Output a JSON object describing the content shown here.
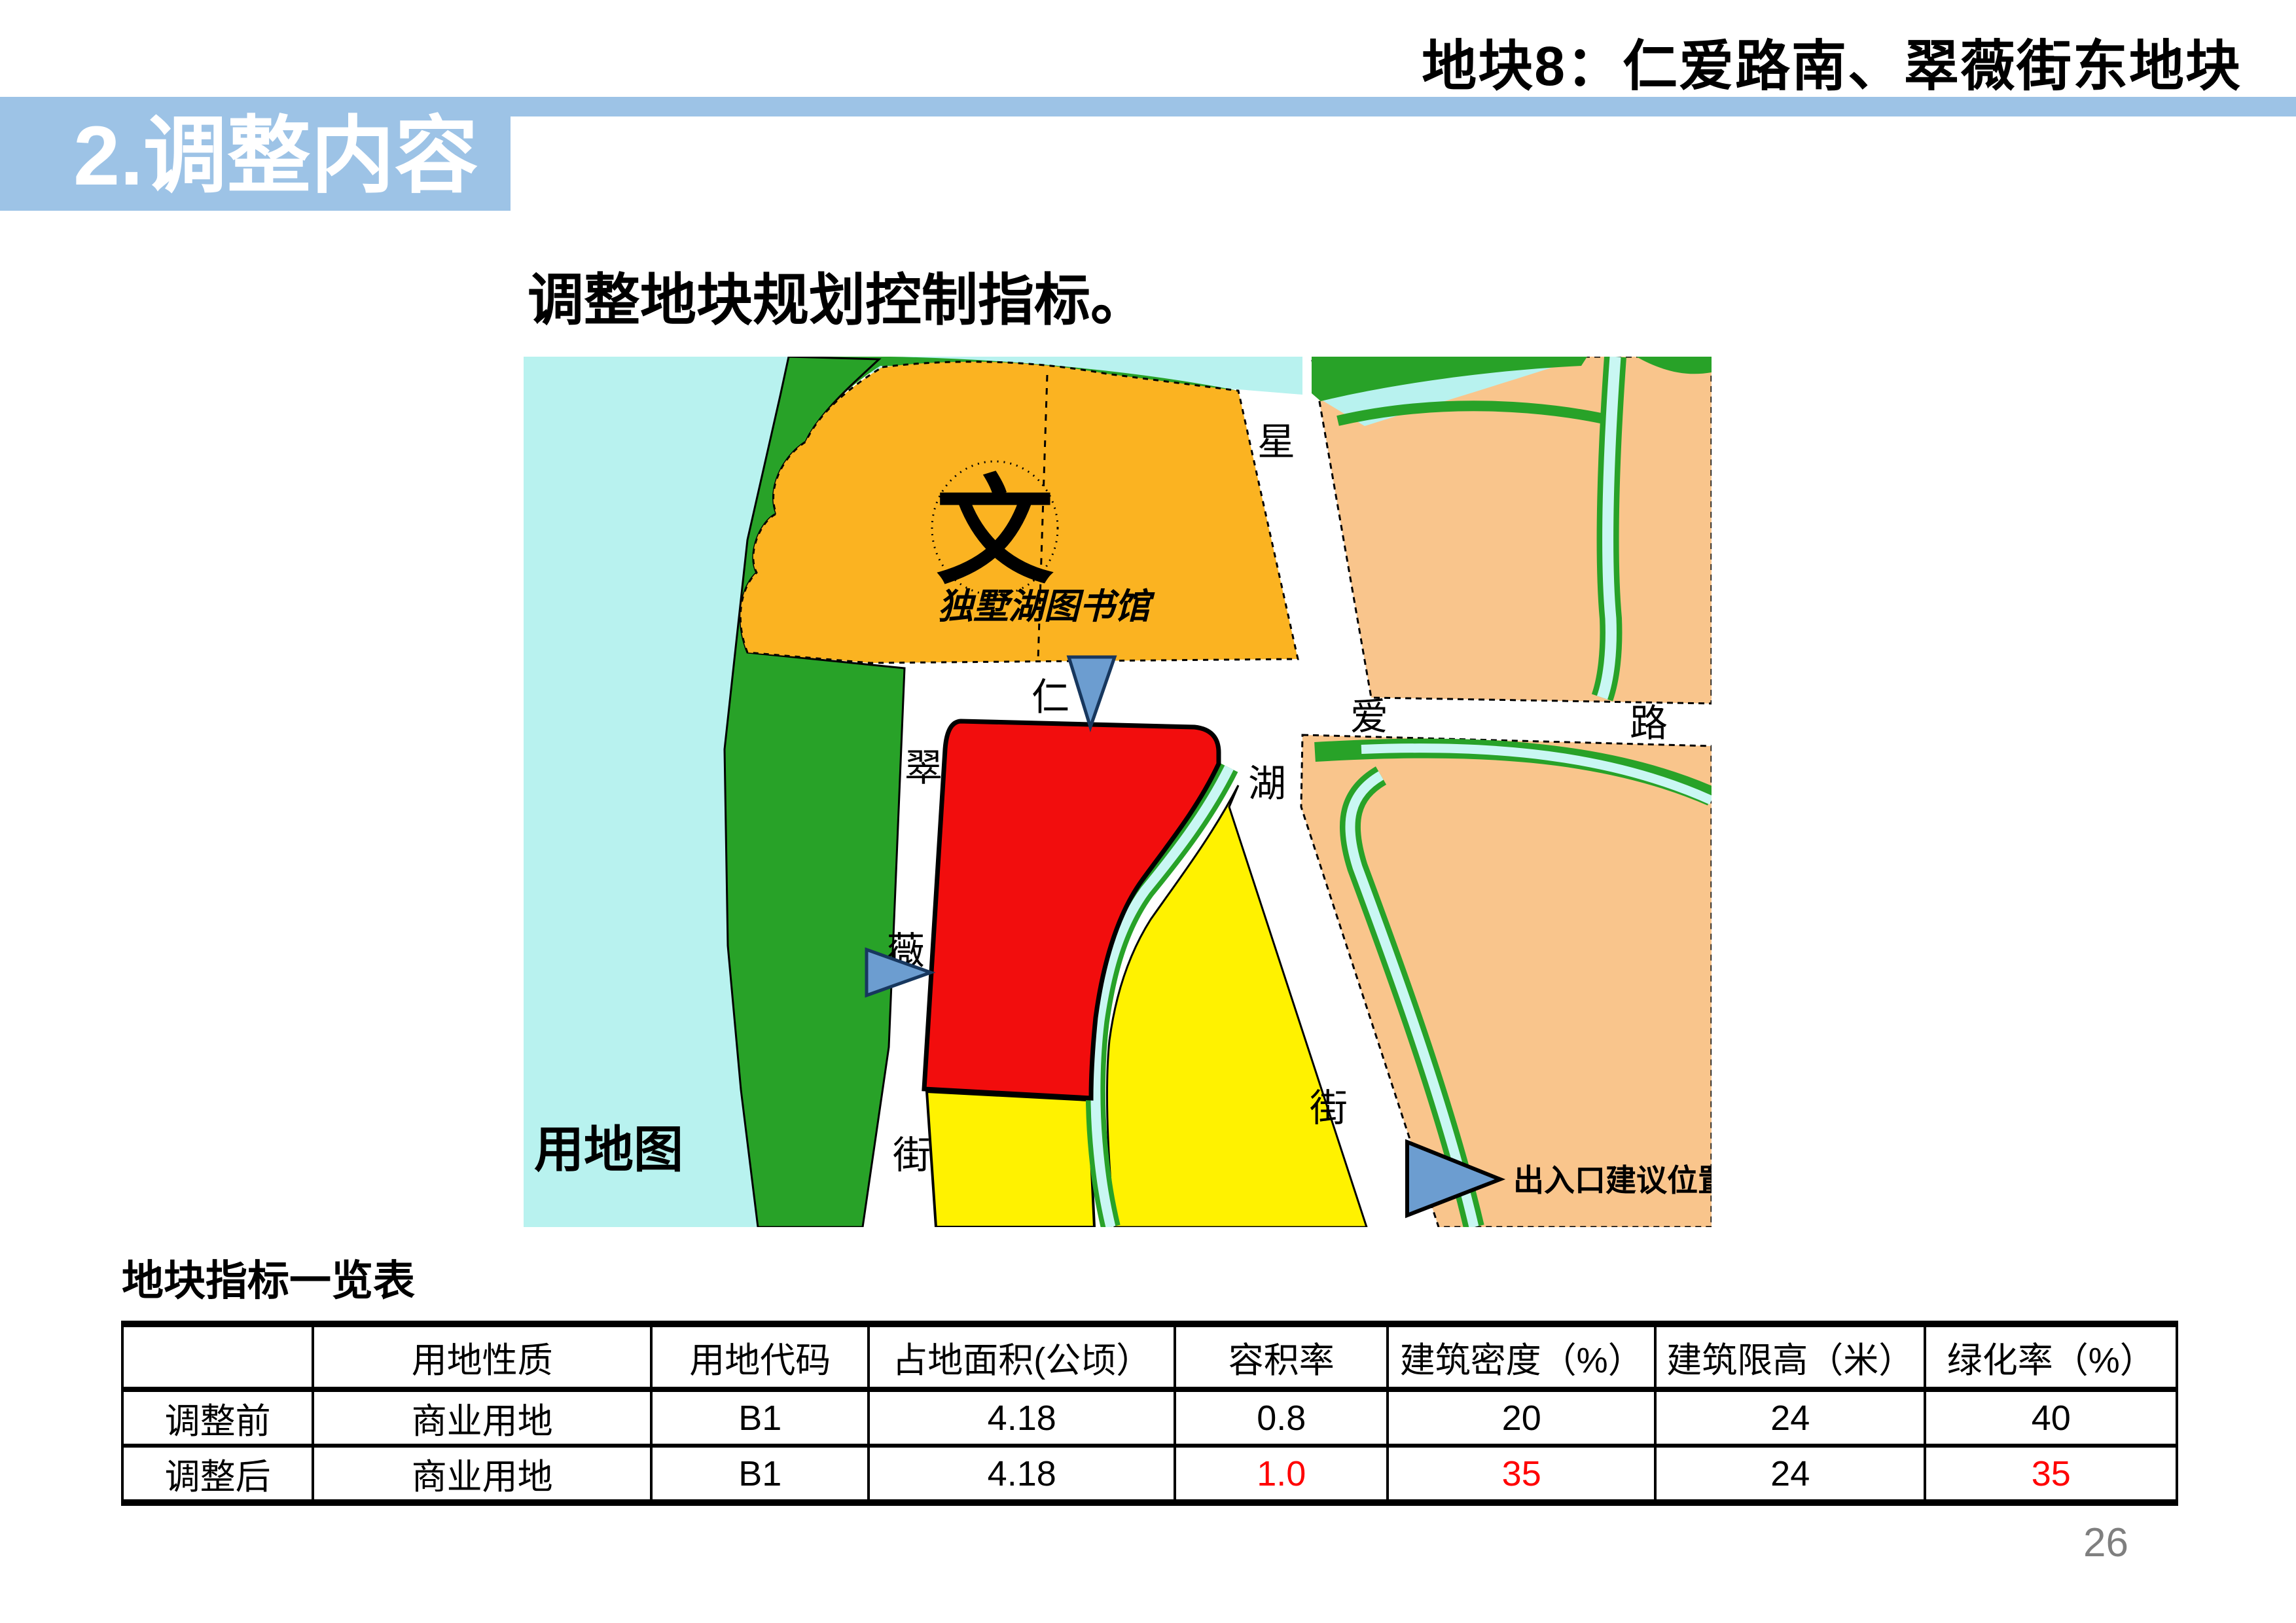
{
  "header": {
    "title": "地块8：仁爱路南、翠薇街东地块"
  },
  "banner": {
    "label": "2.调整内容"
  },
  "body": {
    "intro": "调整地块规划控制指标。"
  },
  "map": {
    "caption": "用地图",
    "marker_label": "出入口建议位置",
    "library_symbol": "文",
    "library_label": "独墅湖图书馆",
    "roads": {
      "renai": [
        "仁",
        "爱",
        "路"
      ],
      "cuiwei": [
        "翠",
        "薇",
        "街"
      ],
      "xinghu": [
        "星",
        "湖",
        "街"
      ]
    }
  },
  "table": {
    "title": "地块指标一览表",
    "columns": [
      "",
      "用地性质",
      "用地代码",
      "占地面积(公顷）",
      "容积率",
      "建筑密度（%）",
      "建筑限高（米）",
      "绿化率（%）"
    ],
    "rows": [
      {
        "label": "调整前",
        "values": [
          "商业用地",
          "B1",
          "4.18",
          "0.8",
          "20",
          "24",
          "40"
        ]
      },
      {
        "label": "调整后",
        "values": [
          "商业用地",
          "B1",
          "4.18",
          "1.0",
          "35",
          "24",
          "35"
        ]
      }
    ]
  },
  "page": {
    "number": "26"
  },
  "colors": {
    "banner_blue": "#9DC3E6",
    "highlight_red": "#FF0000",
    "map_water_cyan": "#B8F2EF",
    "map_canal_cyan": "#C9F7F3",
    "map_green": "#28A228",
    "map_library_orange": "#FBB321",
    "map_residential_peach": "#F9C58C",
    "map_parcel_red": "#F20D0D",
    "map_commercial_yellow": "#FFF200",
    "marker_blue": "#6C9DD0",
    "page_number_gray": "#7F7F7F"
  }
}
